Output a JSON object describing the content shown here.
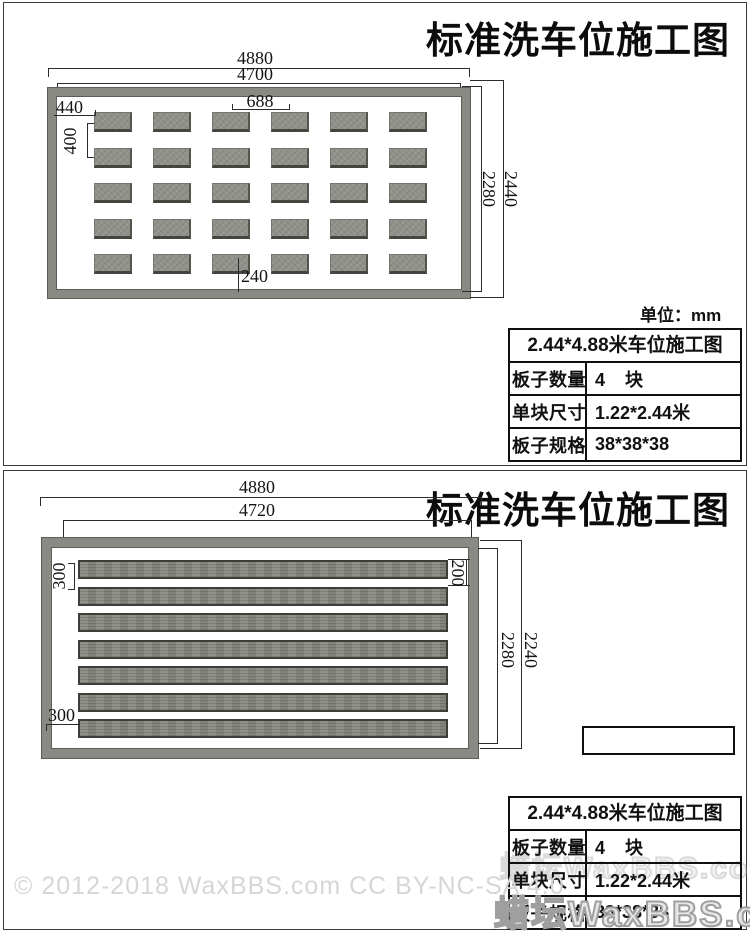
{
  "panel1": {
    "title": "标准洗车位施工图",
    "unit_label": "单位：mm",
    "dims": {
      "outer_width": "4880",
      "inner_width": "4700",
      "block_spacing": "688",
      "left_offset": "440",
      "row_spacing": "400",
      "bottom_offset": "240",
      "inner_height": "2280",
      "outer_height": "2440"
    },
    "table": {
      "header": "2.44*4.88米车位施工图",
      "rows": [
        {
          "label": "板子数量",
          "value": "4    块"
        },
        {
          "label": "单块尺寸",
          "value": "1.22*2.44米"
        },
        {
          "label": "板子规格",
          "value": "38*38*38"
        }
      ]
    }
  },
  "panel2": {
    "title": "标准洗车位施工图",
    "dims": {
      "outer_width": "4880",
      "inner_width": "4720",
      "slat_spacing_left": "300",
      "slat_spacing_right": "200",
      "inner_height": "2280",
      "outer_height": "2240",
      "bottom_offset": "300"
    },
    "table": {
      "header": "2.44*4.88米车位施工图",
      "rows": [
        {
          "label": "板子数量",
          "value": "4    块"
        },
        {
          "label": "单块尺寸",
          "value": "1.22*2.44米"
        },
        {
          "label": "板子规格",
          "value": "38*38*38"
        }
      ]
    }
  },
  "watermarks": {
    "copyright": "© 2012-2018 WaxBBS.com CC BY-NC-SA 4.0",
    "site": "蜡坛WaxBBS.com",
    "site_faint": "蜡坛WaxBBS.com"
  },
  "drawing": {
    "tile_rows": 5,
    "tile_cols": 6,
    "slat_count": 7
  }
}
